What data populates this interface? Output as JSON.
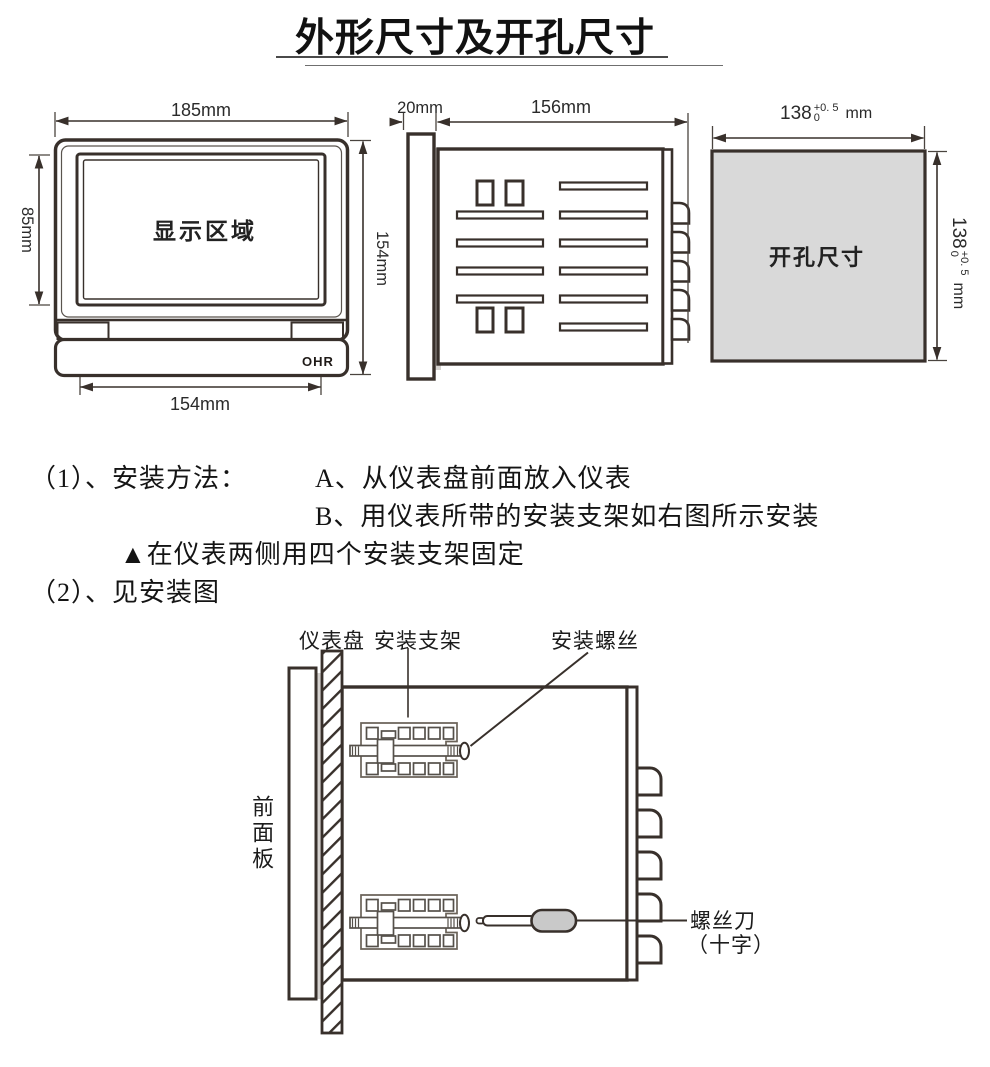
{
  "title": "外形尺寸及开孔尺寸",
  "front_view": {
    "display_area_label": "显示区域",
    "brand_logo": "OHR",
    "width_dim": "185mm",
    "height_dim": "154mm",
    "display_height_dim": "85mm",
    "bottom_width_dim": "154mm"
  },
  "side_view": {
    "bezel_depth_dim": "20mm",
    "body_depth_dim": "156mm"
  },
  "cutout_view": {
    "label": "开孔尺寸",
    "dim_value": "138",
    "tol_plus": "+0. 5",
    "tol_minus": "0",
    "unit": "mm"
  },
  "instructions": {
    "item1_prefix": "（1）、安装方法：",
    "step_a": "A、从仪表盘前面放入仪表",
    "step_b": "B、用仪表所带的安装支架如右图所示安装",
    "note": "▲在仪表两侧用四个安装支架固定",
    "item2": "（2）、见安装图"
  },
  "install_figure": {
    "panel_label": "仪表盘",
    "bracket_label": "安装支架",
    "screw_label": "安装螺丝",
    "front_panel_label": "前面板",
    "screwdriver_label": "螺丝刀",
    "screwdriver_type_label": "（十字）"
  }
}
